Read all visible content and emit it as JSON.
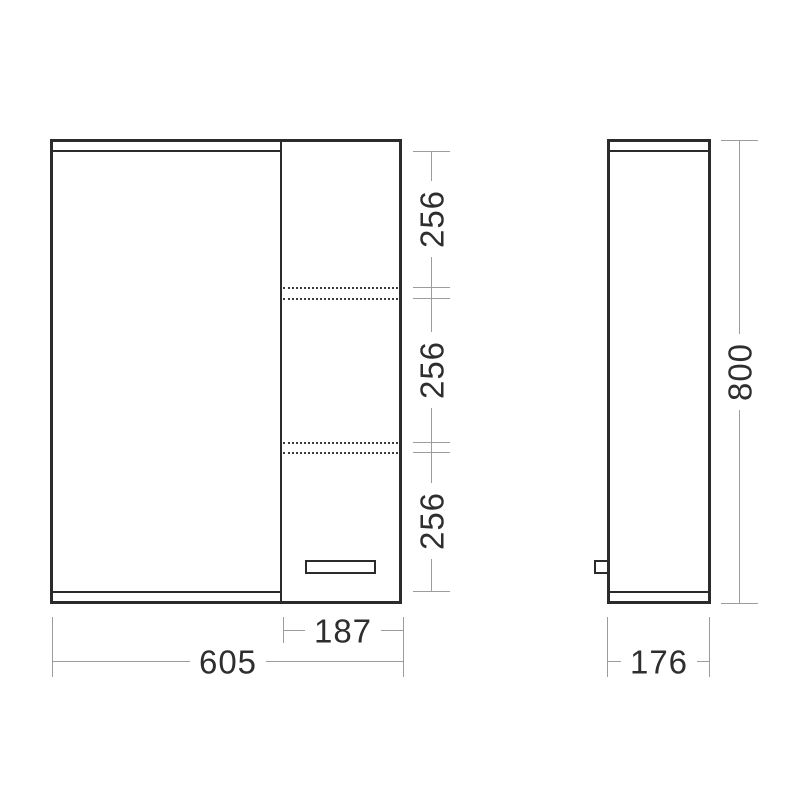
{
  "drawing": {
    "kind": "cabinet-dimension-drawing",
    "views": [
      "front-view",
      "side-view"
    ],
    "colors": {
      "outline": "#2b2b2b",
      "dimension_line": "#9c9c9c",
      "label_text": "#2e2e2e",
      "background": "#ffffff"
    }
  },
  "dimensions": {
    "overall_width": "605",
    "right_section_width": "187",
    "shelf_sections": [
      "256",
      "256",
      "256"
    ],
    "overall_height": "800",
    "depth": "176"
  }
}
